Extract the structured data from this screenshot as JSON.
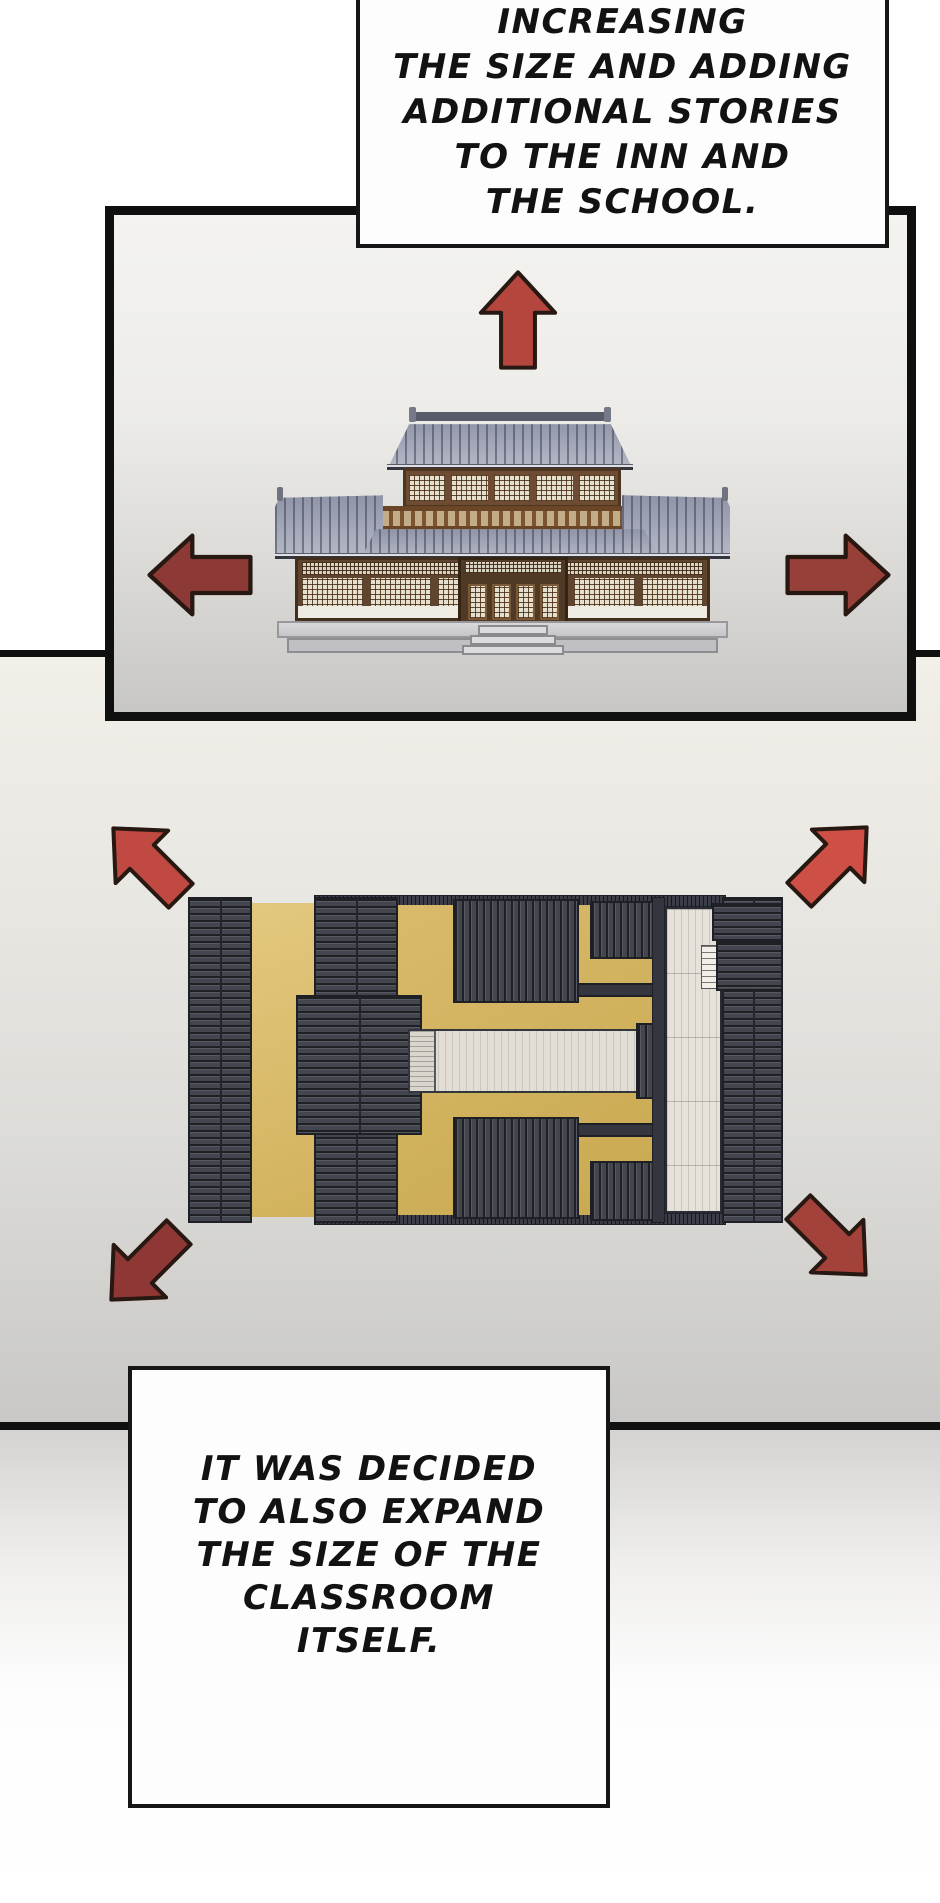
{
  "page": {
    "type": "comic-page",
    "background": "#ffffff"
  },
  "bubbles": {
    "top": {
      "lines": [
        "INCREASING",
        "THE SIZE AND ADDING",
        "ADDITIONAL STORIES",
        "TO THE INN AND",
        "THE SCHOOL."
      ]
    },
    "bottom": {
      "lines": [
        "IT WAS DECIDED",
        "TO ALSO EXPAND",
        "THE SIZE OF THE",
        "CLASSROOM",
        "ITSELF."
      ]
    }
  },
  "panels": {
    "inn": {
      "label": "inn-front-elevation",
      "arrows": {
        "up": {
          "direction": "up",
          "color": "#b5463e"
        },
        "left": {
          "direction": "left",
          "color": "#8d3a36"
        },
        "right": {
          "direction": "right",
          "color": "#97403a"
        }
      }
    },
    "plan": {
      "label": "school-roof-plan",
      "arrows": {
        "up_left": {
          "direction": "up-left",
          "color": "#c04a42"
        },
        "up_right": {
          "direction": "up-right",
          "color": "#cd4f45"
        },
        "down_left": {
          "direction": "down-left",
          "color": "#8e3734"
        },
        "down_right": {
          "direction": "down-right",
          "color": "#a3423a"
        }
      }
    }
  },
  "colors": {
    "panel_border": "#101010",
    "bubble_border": "#161616",
    "bubble_fill": "#fdfdfd",
    "text": "#121212",
    "roof_slate": "#43464f",
    "roof_tile_front": "#9ba0b0",
    "courtyard_gold": "#d3b460",
    "deck": "#e6e2d9",
    "wood_brown": "#6d4c33",
    "platform_gray": "#c9c9cc"
  }
}
